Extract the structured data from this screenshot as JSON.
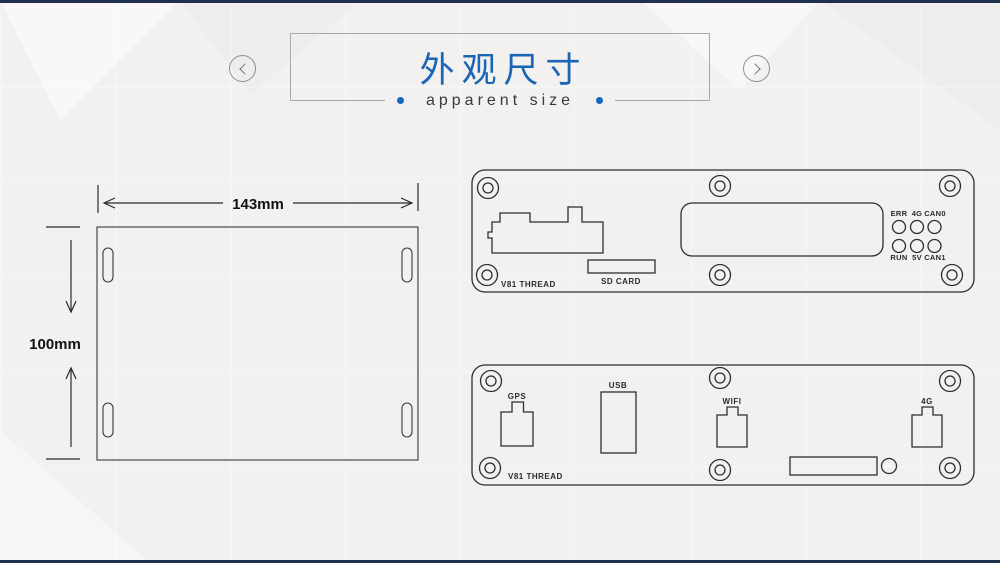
{
  "page": {
    "bg_color": "#f2f1ef",
    "edge_bar_color": "#20304f",
    "accent_blue": "#1565c0",
    "line_color": "#2e2e2e"
  },
  "header": {
    "title": "外观尺寸",
    "title_color": "#1b65b5",
    "subtitle": "apparent size",
    "prev_icon": "chevron-left",
    "next_icon": "chevron-right"
  },
  "top_view": {
    "width_label": "143mm",
    "height_label": "100mm"
  },
  "front_panel": {
    "thread_label": "V81 THREAD",
    "sd_label": "SD CARD",
    "led_top": [
      "ERR",
      "4G",
      "CAN0"
    ],
    "led_bottom": [
      "RUN",
      "5V",
      "CAN1"
    ]
  },
  "rear_panel": {
    "thread_label": "V81 THREAD",
    "gps_label": "GPS",
    "usb_label": "USB",
    "wifi_label": "WIFI",
    "g4_label": "4G"
  }
}
